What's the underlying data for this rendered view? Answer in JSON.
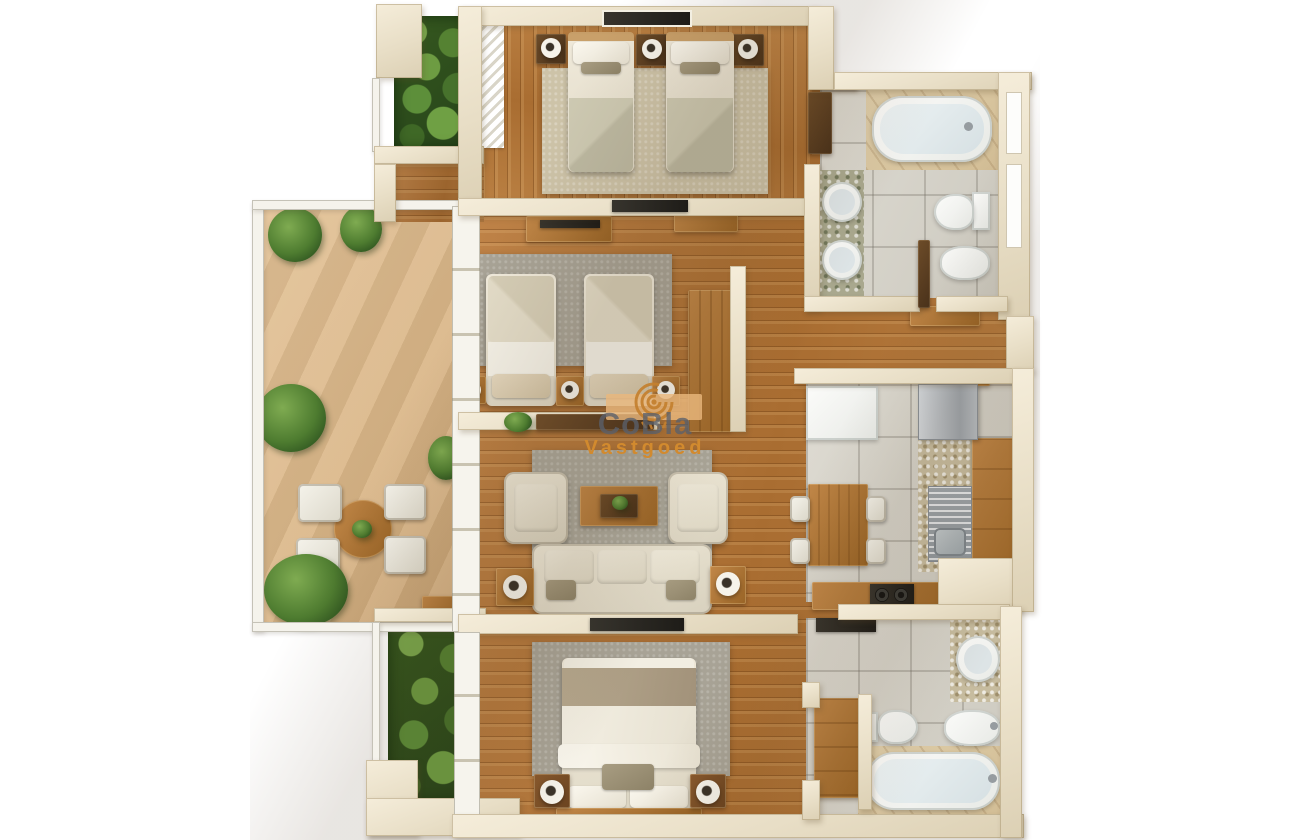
{
  "watermark": {
    "brand": "CoBla",
    "subtitle": "Vastgoed",
    "logo": "spiral-logo"
  },
  "palette": {
    "wall": "#e8dec6",
    "wall_white": "#f5f3ec",
    "wood_floor": "#b5732f",
    "terrace_floor": "#d9b587",
    "tile_floor": "#d6d3ca",
    "rug_beige": "#cdc3a8",
    "rug_gray": "#a8a396",
    "fabric_cream": "#ece6d6",
    "furniture_wood": "#a96f33",
    "furniture_dark": "#5a3e22",
    "fixture_white": "#f4f5f3",
    "plant_green": "#4e7c30",
    "tv_black": "#23211d",
    "brand_gray": "#5a606b",
    "brand_orange": "#d28a2e"
  },
  "floorplan": {
    "type": "apartment-top-view-3d-render",
    "rooms": [
      {
        "id": "balcony-north",
        "features": [
          "planter-greenery"
        ]
      },
      {
        "id": "bedroom-1-twin",
        "features": [
          "two-single-beds",
          "three-nightstands",
          "table-lamps",
          "beige-rug",
          "wardrobe",
          "dresser",
          "wall-picture",
          "louver-closet"
        ]
      },
      {
        "id": "bathroom-1",
        "features": [
          "bathtub",
          "double-round-washbasins",
          "toilet",
          "bidet",
          "door",
          "sideboard",
          "wall-niches"
        ]
      },
      {
        "id": "terrace",
        "features": [
          "round-dining-table",
          "four-chairs",
          "palm-plants",
          "serving-tray"
        ]
      },
      {
        "id": "bedroom-2-twin",
        "features": [
          "two-single-beds",
          "tv-console",
          "sideboard",
          "wardrobe",
          "gray-rug",
          "three-nightstands",
          "plant"
        ]
      },
      {
        "id": "living-room",
        "features": [
          "three-seat-sofa",
          "two-armchairs",
          "coffee-table",
          "two-side-tables",
          "tv",
          "gray-rug"
        ]
      },
      {
        "id": "kitchen-dining",
        "features": [
          "fridge",
          "white-cabinet",
          "granite-counter",
          "steel-sink",
          "wood-counters",
          "cooktop",
          "dining-table",
          "four-chairs"
        ]
      },
      {
        "id": "master-bedroom",
        "features": [
          "double-bed",
          "two-nightstands",
          "table-lamps",
          "gray-rug",
          "tv"
        ]
      },
      {
        "id": "bathroom-2",
        "features": [
          "bathtub",
          "round-washbasin",
          "toilet",
          "bidet",
          "wood-cabinet",
          "shelf"
        ]
      },
      {
        "id": "balcony-south",
        "features": [
          "planter-greenery"
        ]
      },
      {
        "id": "hallway",
        "features": [
          "wood-floor"
        ]
      }
    ]
  }
}
